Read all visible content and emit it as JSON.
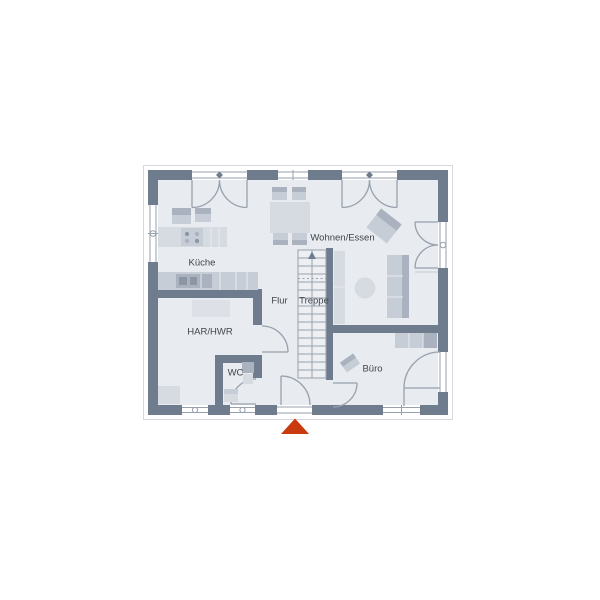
{
  "page": {
    "background": "#ffffff"
  },
  "floor_plan": {
    "rooms": [
      {
        "id": "kueche",
        "label": "Küche"
      },
      {
        "id": "wohnen_essen",
        "label": "Wohnen/Essen"
      },
      {
        "id": "flur",
        "label": "Flur"
      },
      {
        "id": "treppe",
        "label": "Treppe"
      },
      {
        "id": "har_hwr",
        "label": "HAR/HWR"
      },
      {
        "id": "wc",
        "label": "WC"
      },
      {
        "id": "buero",
        "label": "Büro"
      }
    ],
    "markers": {
      "entrance_arrow": "triangle-up",
      "stair_direction": "arrow-up"
    },
    "colors": {
      "wall": "#6f7c8d",
      "floor": "#e8ebef",
      "stairs": "#edeff3",
      "furniture_light": "#d6dae1",
      "furniture_mid": "#c6cdd6",
      "furniture_dark": "#a9b2be",
      "line": "#98a1ae",
      "text": "#41464d",
      "entrance_marker": "#c93a0f"
    }
  }
}
